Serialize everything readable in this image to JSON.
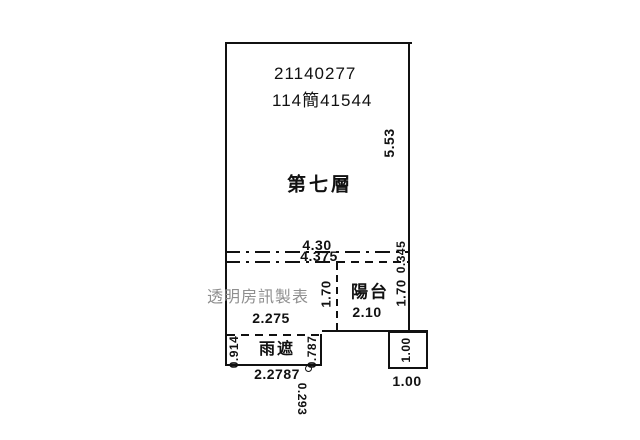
{
  "title_block": {
    "case_number": "21140277",
    "file_number": "114簡41544"
  },
  "watermark_text": "透明房訊製表",
  "areas": {
    "main_floor_label": "第七層",
    "balcony_label": "陽台",
    "rain_shelter_label": "雨遮"
  },
  "dimensions": {
    "main_height_right": "5.53",
    "main_width_upper": "4.30",
    "main_width_lower": "4.375",
    "right_edge_offset": "0.345",
    "balcony_depth_right": "1.70",
    "balcony_depth_left": "1.70",
    "balcony_width": "2.10",
    "interior_width": "2.275",
    "rain_shelter_left_depth": "0.914",
    "rain_shelter_right_depth": "0.787",
    "rain_shelter_width": "2.2787",
    "rain_shelter_offset": "0.293",
    "corner_box_side_vertical": "1.00",
    "corner_box_side_horizontal": "1.00"
  },
  "colors": {
    "line": "#111111",
    "text": "#111111",
    "watermark": "#8f8f8f",
    "background": "#ffffff"
  }
}
